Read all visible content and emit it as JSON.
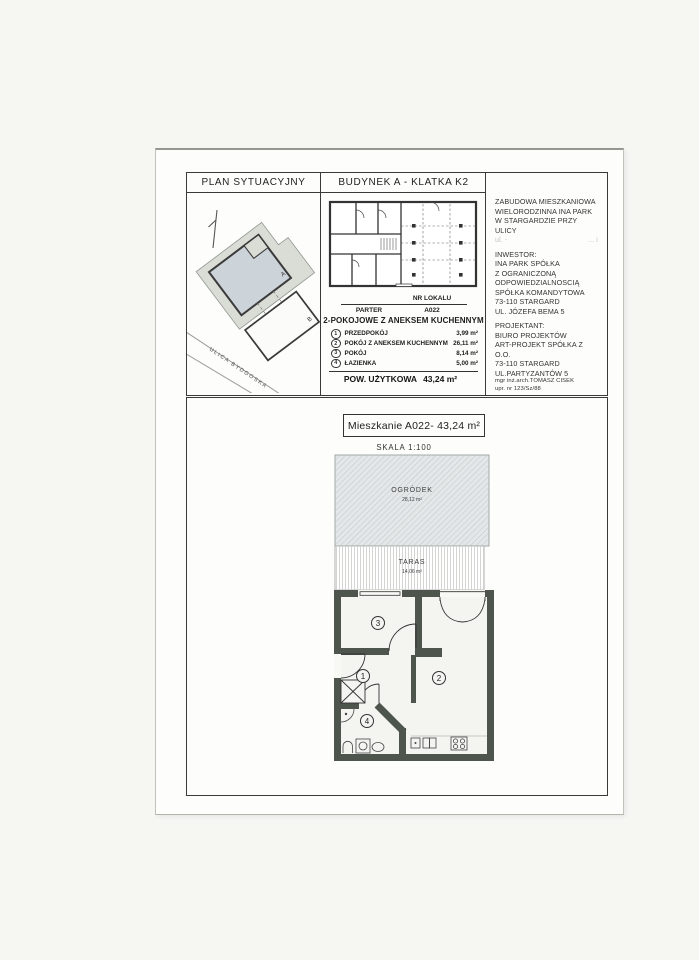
{
  "table": {
    "col1_header": "PLAN SYTUACYJNY",
    "col2_header": "BUDYNEK A - KLATKA K2"
  },
  "site_plan": {
    "street": "ULICA BYDGOSKA",
    "building_a": "A",
    "building_b": "B"
  },
  "building_plan": {
    "floor": "PARTER",
    "unit_label": "NR LOKALU",
    "unit_number": "A022"
  },
  "unit": {
    "type": "2-POKOJOWE Z ANEKSEM KUCHENNYM",
    "rooms": [
      {
        "num": "1",
        "name": "PRZEDPOKÓJ",
        "area": "3,99 m²"
      },
      {
        "num": "2",
        "name": "POKÓJ Z ANEKSEM KUCHENNYM",
        "area": "26,11 m²"
      },
      {
        "num": "3",
        "name": "POKÓJ",
        "area": "8,14 m²"
      },
      {
        "num": "4",
        "name": "ŁAZIENKA",
        "area": "5,00 m²"
      }
    ],
    "total_label": "POW. UŻYTKOWA",
    "total_area": "43,24 m²"
  },
  "project": {
    "line1": "ZABUDOWA MIESZKANIOWA",
    "line2": "WIELORODZINNA INA PARK",
    "line3": "W STARGARDZIE PRZY ULICY",
    "faded_left": "ul. -",
    "faded_right": "... i",
    "investor_label": "INWESTOR:",
    "investor": [
      "INA PARK SPÓŁKA",
      "Z OGRANICZONĄ",
      "ODPOWIEDZIALNOSCIĄ",
      "SPÓŁKA KOMANDYTOWA",
      "73-110 STARGARD",
      "UL. JÓZEFA BEMA 5"
    ],
    "designer_label": "PROJEKTANT:",
    "designer": [
      "BIURO PROJEKTÓW",
      "ART-PROJEKT SPÓŁKA Z O.O.",
      "73-110 STARGARD",
      "UL.PARTYZANTÓW 5"
    ],
    "architect": "mgr inż.arch.TOMASZ CISEK",
    "license": "upr. nr 123/Sz/88"
  },
  "apartment": {
    "title": "Mieszkanie A022- 43,24 m²",
    "scale": "SKALA 1:100",
    "garden": {
      "label": "OGRÓDEK",
      "area": "28,12 m²"
    },
    "terrace": {
      "label": "TARAS",
      "area": "14,06 m²"
    },
    "numbers": {
      "hall": "1",
      "living": "2",
      "room": "3",
      "bath": "4"
    }
  }
}
